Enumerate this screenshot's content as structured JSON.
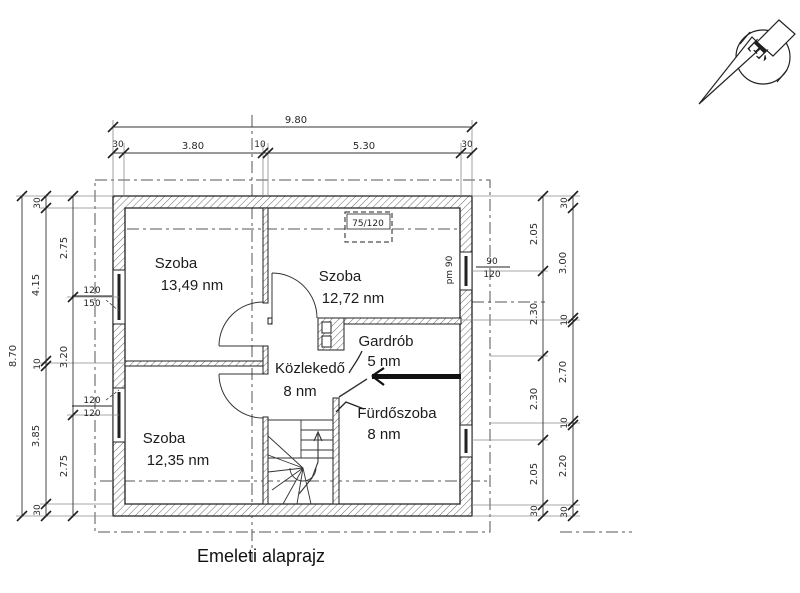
{
  "title": "Emeleti alaprajz",
  "north": {
    "letter": "É"
  },
  "rooms": {
    "szoba1": {
      "name": "Szoba",
      "area": "13,49 nm"
    },
    "szoba2": {
      "name": "Szoba",
      "area": "12,72 nm"
    },
    "gardrob": {
      "name": "Gardrób",
      "area": "5 nm"
    },
    "kozlekedo": {
      "name": "Közlekedő",
      "area": "8 nm"
    },
    "furdoszoba": {
      "name": "Fürdőszoba",
      "area": "8 nm"
    },
    "szoba3": {
      "name": "Szoba",
      "area": "12,35 nm"
    }
  },
  "dims": {
    "top": {
      "overall": "9.80",
      "segs": [
        "30",
        "3.80",
        "10",
        "5.30",
        "30"
      ]
    },
    "left": {
      "overall": "8.70",
      "mid": [
        "30",
        "4.15",
        "10",
        "3.85",
        "30"
      ],
      "inner": [
        "2.75",
        "3.20",
        "2.75"
      ]
    },
    "right": {
      "inner": [
        "2.05",
        "2.30",
        "2.30",
        "2.05",
        "30"
      ],
      "outer": [
        "30",
        "3.00",
        "10",
        "2.70",
        "10",
        "2.20",
        "30"
      ]
    }
  },
  "openings": {
    "roof_window": "75/120",
    "win_left_top_w": "120",
    "win_left_top_h": "150",
    "win_left_bot_w": "120",
    "win_left_bot_h": "120",
    "win_right_w": "90",
    "win_right_h": "120",
    "win_right_sill": "pm 90"
  },
  "colors": {
    "ink": "#2a2a2a",
    "hatch": "#6a6a6a",
    "heavy_wall": "#111111"
  }
}
